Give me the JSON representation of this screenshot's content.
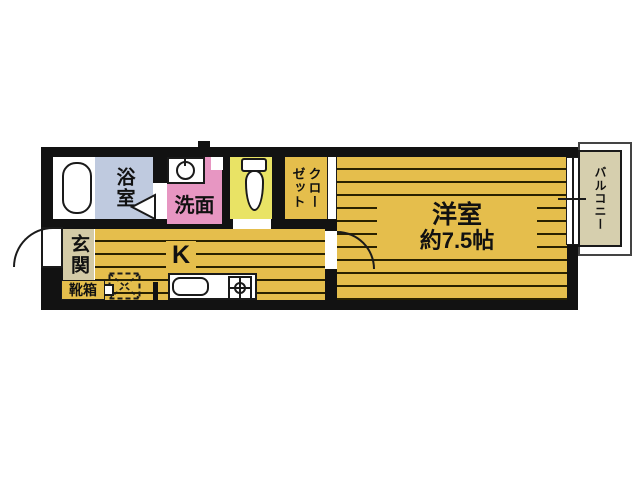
{
  "title": "1K apartment floor plan",
  "colors": {
    "wall": "#121212",
    "outline": "#1a1a1a",
    "floor": "#e5be4c",
    "floorline": "#2a2200",
    "bath": "#bfcadf",
    "wash": "#e796c2",
    "toiletbg": "#e9e365",
    "beige": "#d3caa6",
    "balconybeige": "#d6cfae",
    "white": "#ffffff"
  },
  "rooms": {
    "bath": {
      "label": "浴室"
    },
    "washroom": {
      "label": "洗面"
    },
    "toilet": {
      "label": ""
    },
    "closet": {
      "label": "クローゼット",
      "label_right": "クロー",
      "label_left": "ゼット"
    },
    "kitchen": {
      "label": "K"
    },
    "entrance": {
      "label": "玄関"
    },
    "shoebox": {
      "label": "靴箱"
    },
    "western_room": {
      "label": "洋室",
      "size": "約7.5帖"
    },
    "balcony": {
      "label": "バルコニー"
    }
  },
  "icons": {
    "bathtub": "bathtub-icon",
    "washing_machine": "washing-machine-icon",
    "toilet": "toilet-icon",
    "kitchen_sink": "sink-icon",
    "stove": "stove-burner-icon",
    "refrigerator_space": "refrigerator-space-icon",
    "entry_door": "door-swing-icon",
    "window": "sliding-window-icon"
  }
}
